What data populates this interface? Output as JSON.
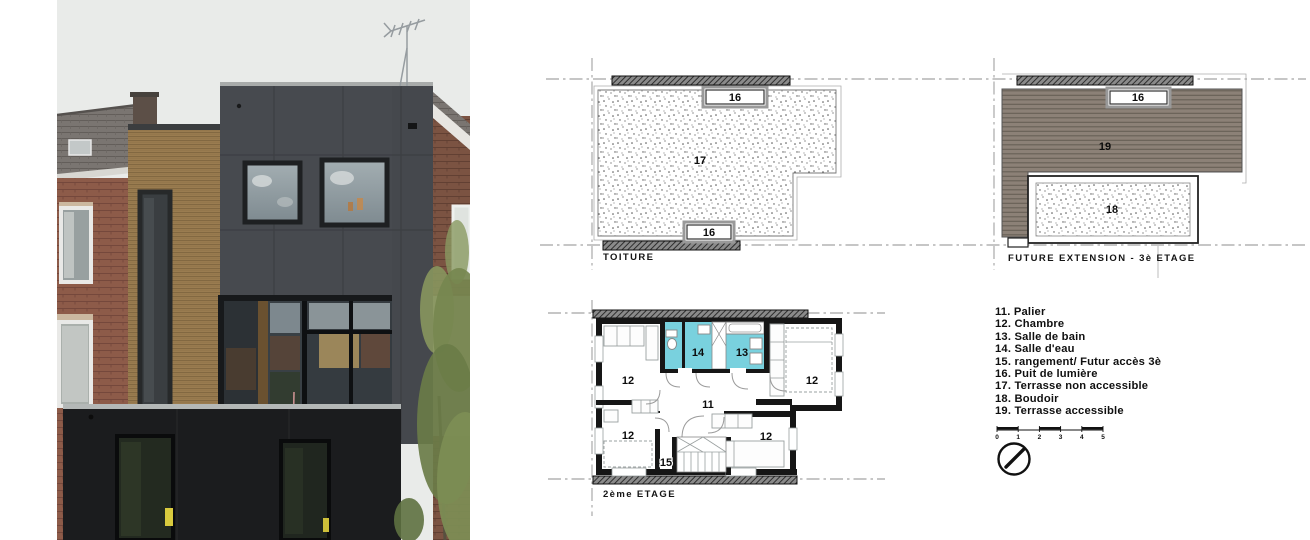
{
  "sheet": {
    "background": "#ffffff"
  },
  "photo": {
    "description": "rear facade photo of modern extension",
    "colors": {
      "sky": "#e9ebe9",
      "dark_facade": "#474a4f",
      "ground_floor": "#1b1c1e",
      "wood_cladding": "#9a7c50",
      "brick_left": "#8d5b49",
      "brick_right": "#7b5342",
      "roof_tiles": "#7a7571",
      "foliage": "#76874f",
      "glass_reflection": "#9aa5ab"
    }
  },
  "plans": {
    "toiture": {
      "title": "TOITURE",
      "labels": {
        "skylight_top": "16",
        "terrace": "17",
        "skylight_bottom": "16"
      }
    },
    "extension": {
      "title": "FUTURE EXTENSION - 3è ETAGE",
      "labels": {
        "skylight": "16",
        "deck": "19",
        "boudoir": "18"
      }
    },
    "etage2": {
      "title": "2ème ETAGE",
      "labels": {
        "landing": "11",
        "bedroom_top_left": "12",
        "bedroom_top_right": "12",
        "bedroom_bottom_left": "12",
        "bedroom_bottom_right": "12",
        "bathroom": "13",
        "shower_room": "14",
        "storage": "15"
      }
    },
    "scale": {
      "ticks": [
        "0",
        "1",
        "2",
        "3",
        "4",
        "5"
      ]
    },
    "colors": {
      "wet_room": "#79d1de",
      "deck": "#8c8177",
      "wall": "#161616"
    }
  },
  "legend": {
    "items": [
      "11. Palier",
      "12. Chambre",
      "13. Salle de bain",
      "14. Salle d'eau",
      "15. rangement/ Futur accès 3è",
      "16. Puit de lumière",
      "17. Terrasse non accessible",
      "18. Boudoir",
      "19. Terrasse accessible"
    ]
  }
}
